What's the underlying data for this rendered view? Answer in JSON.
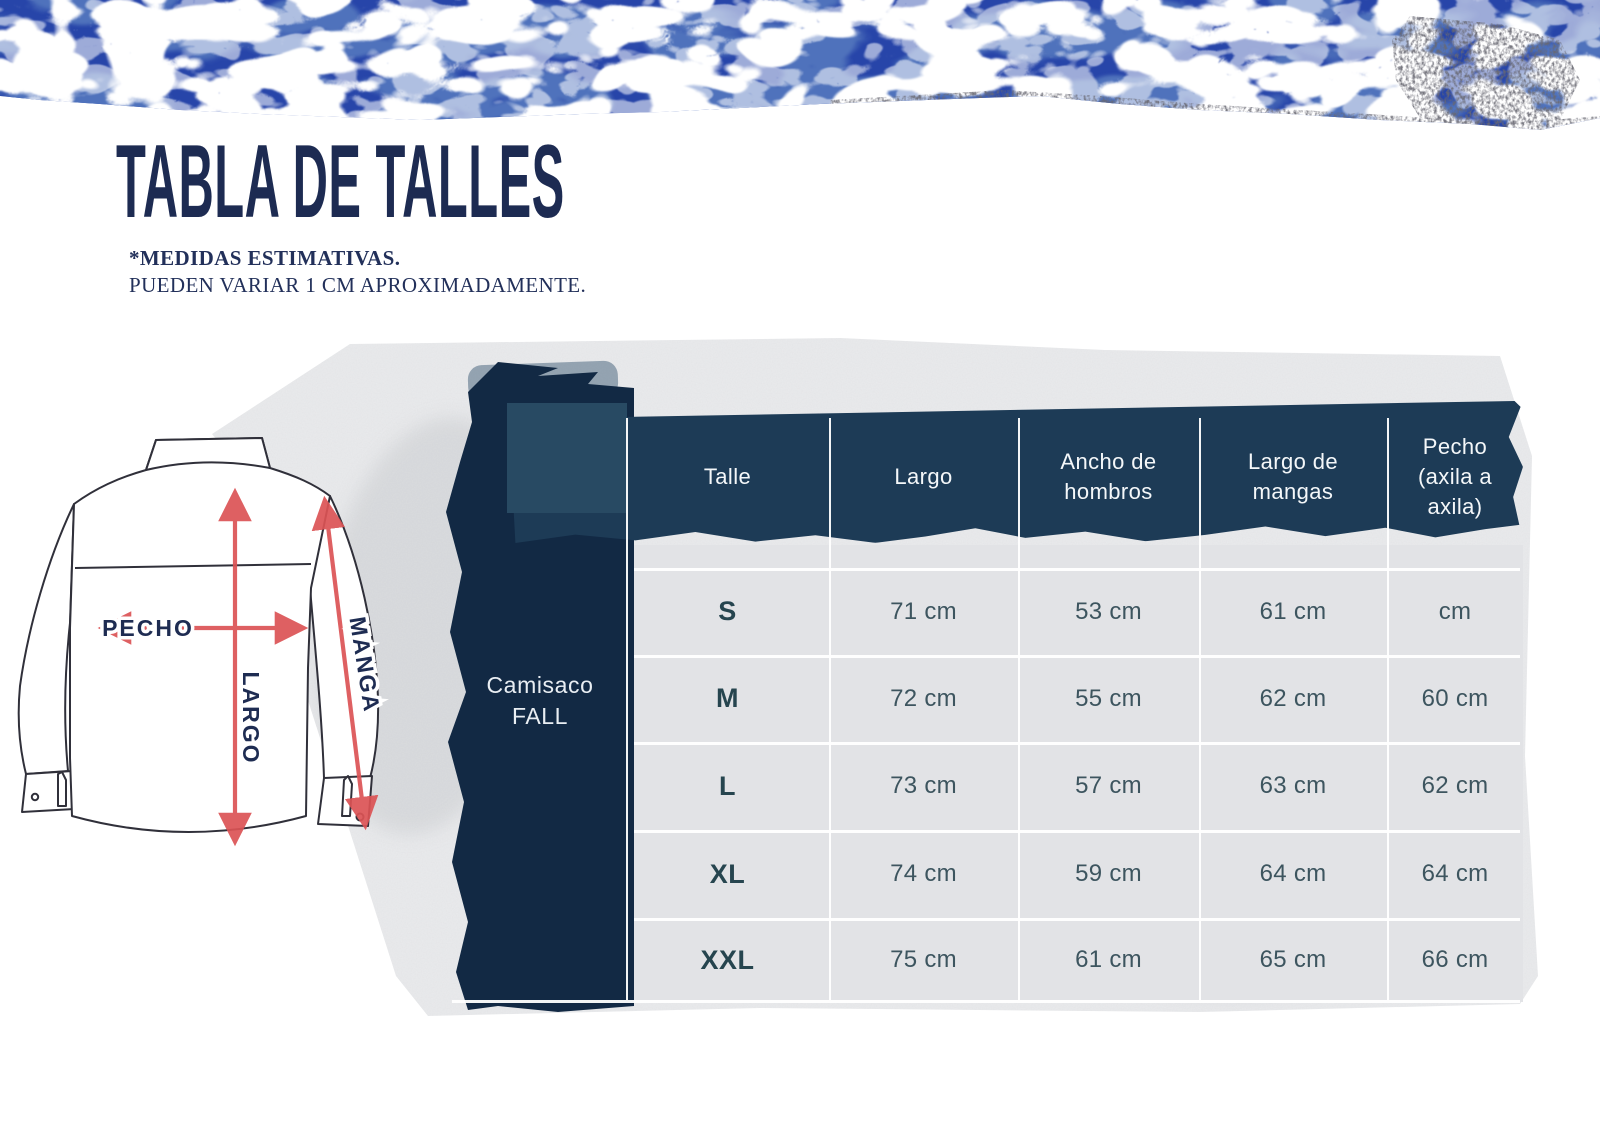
{
  "page": {
    "title": "TABLA DE TALLES",
    "disclaimer1": "*MEDIDAS ESTIMATIVAS.",
    "disclaimer2": "PUEDEN VARIAR 1 CM APROXIMADAMENTE."
  },
  "product": {
    "line1": "Camisaco",
    "line2": "FALL"
  },
  "diagram": {
    "pecho": "PECHO",
    "largo": "LARGO",
    "manga": "MANGA"
  },
  "table": {
    "columns": [
      "Talle",
      "Largo",
      "Ancho de hombros",
      "Largo de mangas",
      "Pecho (axila a axila)"
    ],
    "rows": [
      {
        "label": "S",
        "values": [
          "71 cm",
          "53 cm",
          "61 cm",
          "cm"
        ]
      },
      {
        "label": "M",
        "values": [
          "72 cm",
          "55 cm",
          "62 cm",
          "60 cm"
        ]
      },
      {
        "label": "L",
        "values": [
          "73 cm",
          "57 cm",
          "63 cm",
          "62 cm"
        ]
      },
      {
        "label": "XL",
        "values": [
          "74 cm",
          "59 cm",
          "64 cm",
          "64 cm"
        ]
      },
      {
        "label": "XXL",
        "values": [
          "75 cm",
          "61 cm",
          "65 cm",
          "66 cm"
        ]
      }
    ]
  },
  "colors": {
    "water_blue": "#2745a9",
    "band_navy": "#1d3b56",
    "stroke_navy": "#122944",
    "title_navy": "#1d2b52",
    "arrow_red": "#dc5355",
    "value_text": "#3d555f"
  }
}
